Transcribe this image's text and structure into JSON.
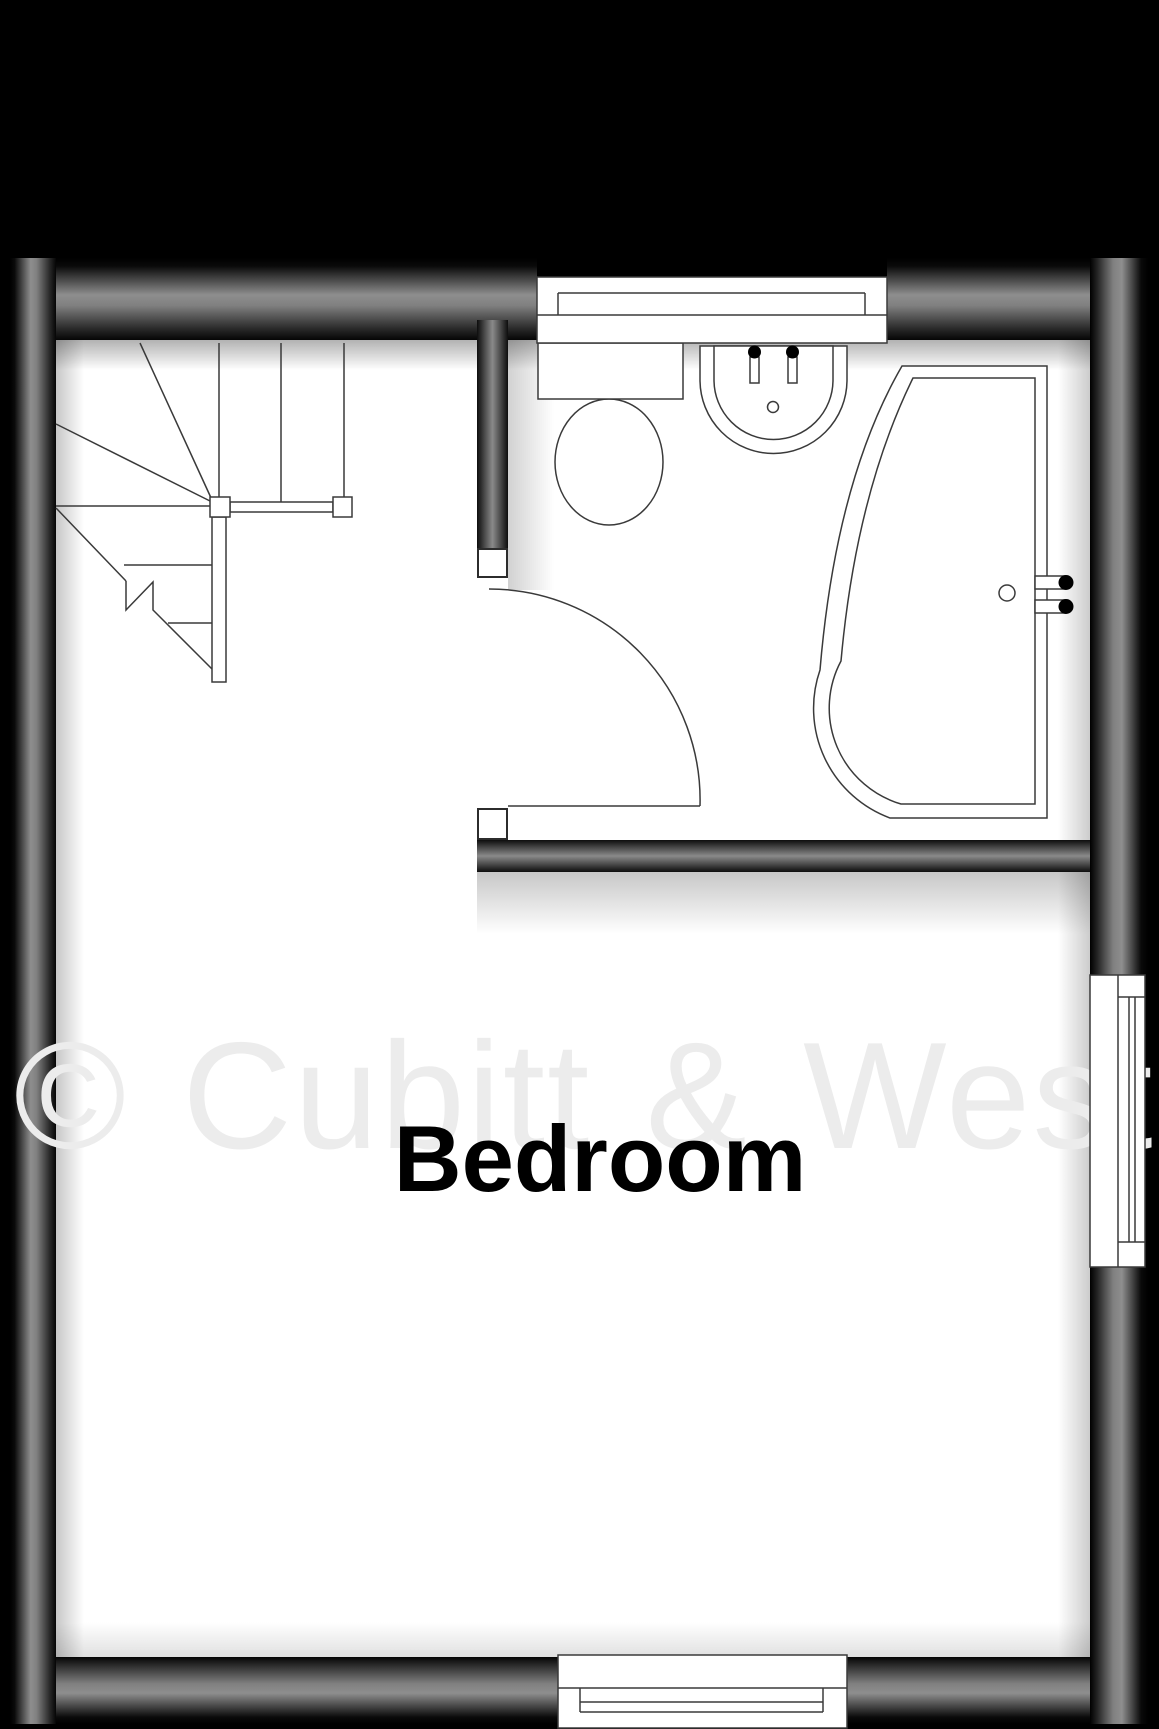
{
  "floorplan": {
    "watermark": "© Cubitt & West",
    "rooms": [
      {
        "label": "Bedroom"
      }
    ],
    "fixtures": [
      "winder-staircase",
      "stair-handrail",
      "toilet",
      "wash-basin",
      "p-shaped-bath",
      "bathroom-door-swing"
    ],
    "windows": [
      "top-window",
      "right-window",
      "bottom-window"
    ],
    "colors": {
      "background": "#000000",
      "wall_mid": "#8e8e8e",
      "wall_edge": "#000000",
      "floor": "#ffffff",
      "outline": "#3a3a3a",
      "watermark": "#ececec",
      "room_label": "#000000"
    }
  }
}
